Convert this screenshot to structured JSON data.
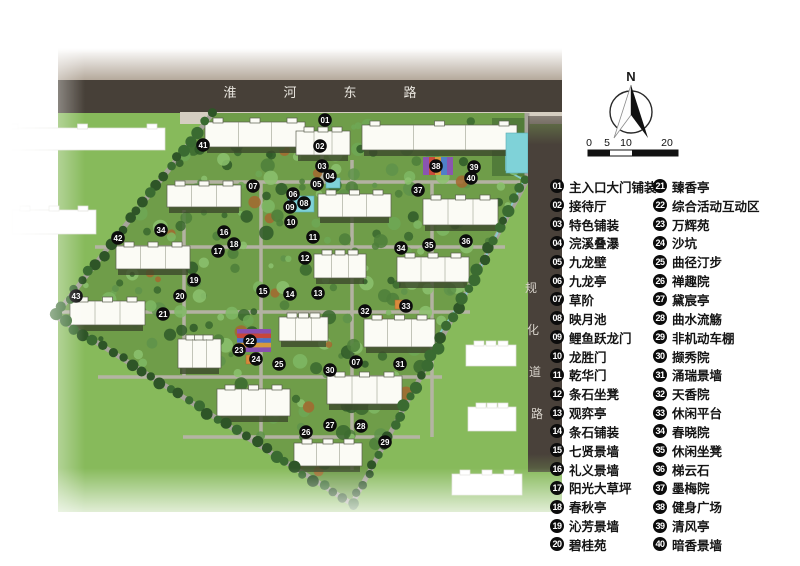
{
  "plan": {
    "top_road_chars": [
      "淮",
      "河",
      "东",
      "路"
    ],
    "side_road_chars": [
      "规",
      "化",
      "道",
      "路"
    ],
    "markers": [
      {
        "n": "01",
        "x": 325,
        "y": 120
      },
      {
        "n": "02",
        "x": 320,
        "y": 146
      },
      {
        "n": "03",
        "x": 322,
        "y": 166
      },
      {
        "n": "04",
        "x": 330,
        "y": 176
      },
      {
        "n": "05",
        "x": 317,
        "y": 184
      },
      {
        "n": "06",
        "x": 293,
        "y": 194
      },
      {
        "n": "07",
        "x": 253,
        "y": 186
      },
      {
        "n": "08",
        "x": 304,
        "y": 203
      },
      {
        "n": "09",
        "x": 290,
        "y": 207
      },
      {
        "n": "10",
        "x": 291,
        "y": 222
      },
      {
        "n": "11",
        "x": 313,
        "y": 237
      },
      {
        "n": "12",
        "x": 305,
        "y": 258
      },
      {
        "n": "13",
        "x": 318,
        "y": 293
      },
      {
        "n": "14",
        "x": 290,
        "y": 294
      },
      {
        "n": "15",
        "x": 263,
        "y": 291
      },
      {
        "n": "16",
        "x": 224,
        "y": 232
      },
      {
        "n": "17",
        "x": 218,
        "y": 251
      },
      {
        "n": "18",
        "x": 234,
        "y": 244
      },
      {
        "n": "19",
        "x": 194,
        "y": 280
      },
      {
        "n": "20",
        "x": 180,
        "y": 296
      },
      {
        "n": "21",
        "x": 163,
        "y": 314
      },
      {
        "n": "22",
        "x": 250,
        "y": 341
      },
      {
        "n": "23",
        "x": 239,
        "y": 350
      },
      {
        "n": "24",
        "x": 256,
        "y": 359
      },
      {
        "n": "25",
        "x": 279,
        "y": 364
      },
      {
        "n": "26",
        "x": 306,
        "y": 432
      },
      {
        "n": "27",
        "x": 330,
        "y": 425
      },
      {
        "n": "28",
        "x": 361,
        "y": 426
      },
      {
        "n": "29",
        "x": 385,
        "y": 442
      },
      {
        "n": "30",
        "x": 330,
        "y": 370
      },
      {
        "n": "31",
        "x": 400,
        "y": 364
      },
      {
        "n": "32",
        "x": 365,
        "y": 311
      },
      {
        "n": "33",
        "x": 406,
        "y": 306
      },
      {
        "n": "34",
        "x": 401,
        "y": 248
      },
      {
        "n": "34",
        "x": 161,
        "y": 230
      },
      {
        "n": "35",
        "x": 429,
        "y": 245
      },
      {
        "n": "36",
        "x": 466,
        "y": 241
      },
      {
        "n": "37",
        "x": 418,
        "y": 190
      },
      {
        "n": "38",
        "x": 436,
        "y": 166
      },
      {
        "n": "39",
        "x": 474,
        "y": 167
      },
      {
        "n": "40",
        "x": 471,
        "y": 178
      },
      {
        "n": "41",
        "x": 203,
        "y": 145
      },
      {
        "n": "42",
        "x": 118,
        "y": 238
      },
      {
        "n": "43",
        "x": 76,
        "y": 296
      },
      {
        "n": "07",
        "x": 356,
        "y": 362
      }
    ]
  },
  "compass": {
    "north_label": "N"
  },
  "scale_bar": {
    "labels": [
      "0",
      "5",
      "10",
      "20"
    ]
  },
  "legend": {
    "columns": [
      [
        {
          "num": "01",
          "label": "主入口大门铺装"
        },
        {
          "num": "02",
          "label": "接待厅"
        },
        {
          "num": "03",
          "label": "特色铺装"
        },
        {
          "num": "04",
          "label": "浣溪叠瀑"
        },
        {
          "num": "05",
          "label": "九龙壁"
        },
        {
          "num": "06",
          "label": "九龙亭"
        },
        {
          "num": "07",
          "label": "草阶"
        },
        {
          "num": "08",
          "label": "映月池"
        },
        {
          "num": "09",
          "label": "鲤鱼跃龙门"
        },
        {
          "num": "10",
          "label": "龙胜门"
        },
        {
          "num": "11",
          "label": "乾华门"
        },
        {
          "num": "12",
          "label": "条石坐凳"
        },
        {
          "num": "13",
          "label": "观弈亭"
        },
        {
          "num": "14",
          "label": "条石铺装"
        },
        {
          "num": "15",
          "label": "七贤景墙"
        },
        {
          "num": "16",
          "label": "礼义景墙"
        },
        {
          "num": "17",
          "label": "阳光大草坪"
        },
        {
          "num": "18",
          "label": "春秋亭"
        },
        {
          "num": "19",
          "label": "沁芳景墙"
        },
        {
          "num": "20",
          "label": "碧桂苑"
        }
      ],
      [
        {
          "num": "21",
          "label": "臻香亭"
        },
        {
          "num": "22",
          "label": "综合活动互动区"
        },
        {
          "num": "23",
          "label": "万辉苑"
        },
        {
          "num": "24",
          "label": "沙坑"
        },
        {
          "num": "25",
          "label": "曲径汀步"
        },
        {
          "num": "26",
          "label": "禅趣院"
        },
        {
          "num": "27",
          "label": "黛宸亭"
        },
        {
          "num": "28",
          "label": "曲水流觞"
        },
        {
          "num": "29",
          "label": "非机动车棚"
        },
        {
          "num": "30",
          "label": "撷秀院"
        },
        {
          "num": "31",
          "label": "涌瑞景墙"
        },
        {
          "num": "32",
          "label": "天香院"
        },
        {
          "num": "33",
          "label": "休闲平台"
        },
        {
          "num": "34",
          "label": "春晓院"
        },
        {
          "num": "35",
          "label": "休闲坐凳"
        },
        {
          "num": "36",
          "label": "梯云石"
        },
        {
          "num": "37",
          "label": "墨梅院"
        },
        {
          "num": "38",
          "label": "健身广场"
        },
        {
          "num": "39",
          "label": "清风亭"
        },
        {
          "num": "40",
          "label": "暗香景墙"
        }
      ]
    ]
  },
  "colors": {
    "grass_outside": "#87ba5b",
    "site_green": "#6f9d49",
    "road_band": "#474038",
    "sidewalk": "#d5cec1",
    "path_gray": "#b6b3a8",
    "marker_bg": "#0c0c0c",
    "water_cyan": "#85cfd5",
    "fitness_red": "#b8453a",
    "legend_text": "#141414"
  }
}
